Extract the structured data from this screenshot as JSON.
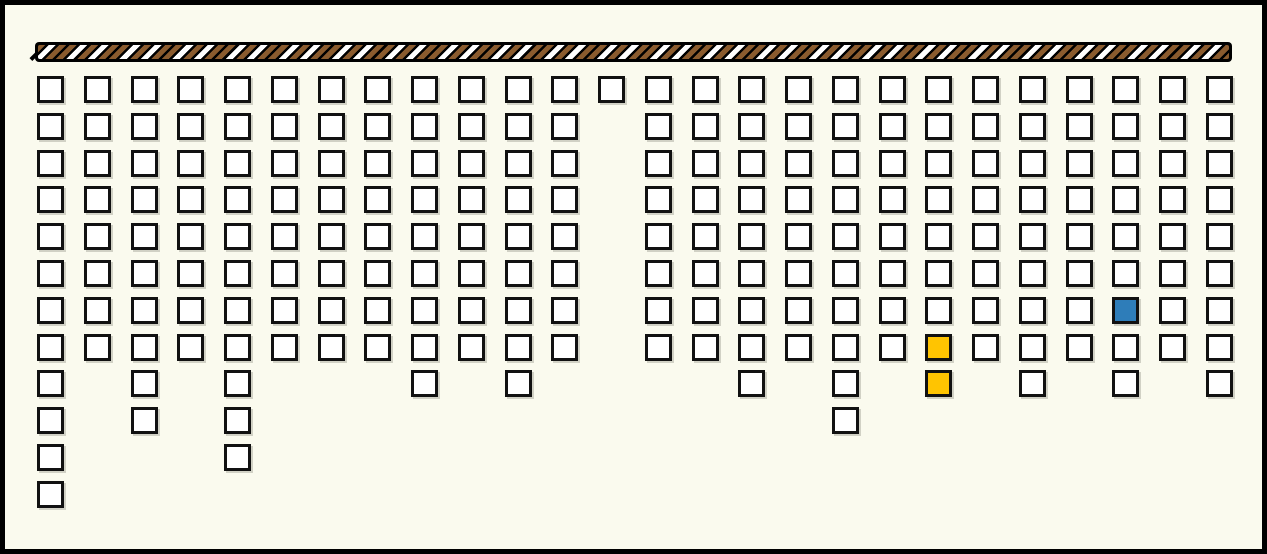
{
  "scene": {
    "description": "Black-framed cream panel with a brown and white hazard-striped bar across the top and 26 columns of white unit squares hanging below it; one blue and two gold highlighted squares",
    "background_color": "#FAFAEE",
    "frame_color": "#000000"
  },
  "bar": {
    "base_color": "#000000",
    "stripe_brown": "#8A5B2E",
    "stripe_white": "#FFFFFF"
  },
  "grid": {
    "cell_fill": "#FFFFFF",
    "cell_border": "#111111",
    "highlight_colors": {
      "gold": "#FFC401",
      "blue": "#2E7DB9"
    },
    "num_columns": 26,
    "max_rows": 12,
    "columns": [
      {
        "count": 12
      },
      {
        "count": 8
      },
      {
        "count": 10
      },
      {
        "count": 8
      },
      {
        "count": 11
      },
      {
        "count": 8
      },
      {
        "count": 8
      },
      {
        "count": 8
      },
      {
        "count": 9
      },
      {
        "count": 8
      },
      {
        "count": 9
      },
      {
        "count": 8
      },
      {
        "count": 1
      },
      {
        "count": 8
      },
      {
        "count": 8
      },
      {
        "count": 9
      },
      {
        "count": 8
      },
      {
        "count": 10
      },
      {
        "count": 8
      },
      {
        "count": 9,
        "highlights": [
          {
            "row": 8,
            "color": "#FFC401",
            "name": "highlighted-cell-gold"
          },
          {
            "row": 9,
            "color": "#FFC401",
            "name": "highlighted-cell-gold"
          }
        ]
      },
      {
        "count": 8
      },
      {
        "count": 9
      },
      {
        "count": 8
      },
      {
        "count": 9,
        "highlights": [
          {
            "row": 7,
            "color": "#2E7DB9",
            "name": "highlighted-cell-blue"
          }
        ]
      },
      {
        "count": 8
      },
      {
        "count": 9
      }
    ]
  }
}
